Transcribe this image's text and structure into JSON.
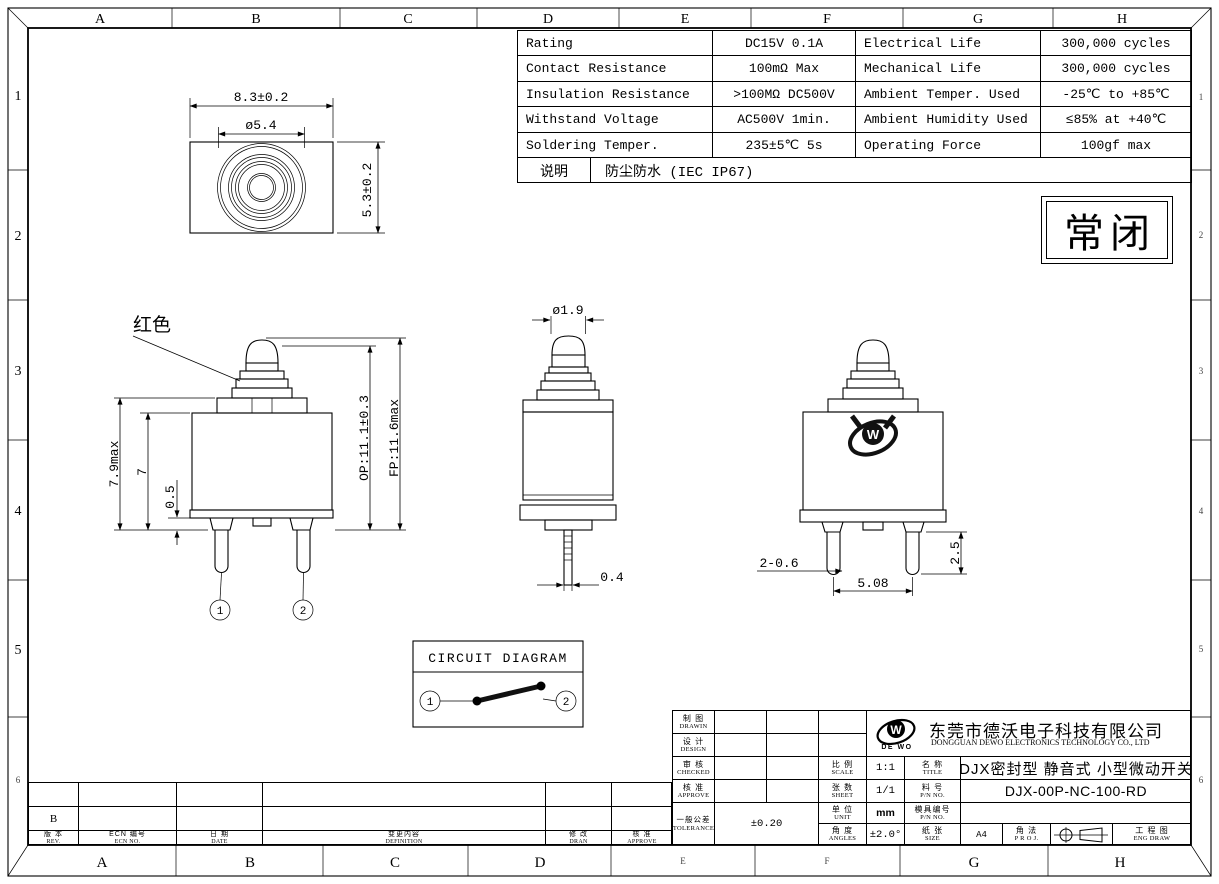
{
  "sheet": {
    "grid_top": [
      "A",
      "B",
      "C",
      "D",
      "E",
      "F",
      "G",
      "H"
    ],
    "grid_bottom": [
      "A",
      "B",
      "C",
      "D",
      "E",
      "F",
      "G",
      "H"
    ],
    "grid_left": [
      "1",
      "2",
      "3",
      "4",
      "5",
      "6"
    ],
    "grid_right": [
      "1",
      "2",
      "3",
      "4",
      "5",
      "6"
    ]
  },
  "spec_table": {
    "rows": [
      [
        "Rating",
        "DC15V 0.1A",
        "Electrical Life",
        "300,000 cycles"
      ],
      [
        "Contact Resistance",
        "100mΩ Max",
        "Mechanical Life",
        "300,000 cycles"
      ],
      [
        "Insulation Resistance",
        ">100MΩ DC500V",
        "Ambient Temper. Used",
        "-25℃ to +85℃"
      ],
      [
        "Withstand Voltage",
        "AC500V 1min.",
        "Ambient Humidity Used",
        "≤85% at +40℃"
      ],
      [
        "Soldering Temper.",
        "235±5℃ 5s",
        "Operating Force",
        "100gf max"
      ]
    ],
    "note_label": "说明",
    "note_value": "防尘防水 (IEC IP67)"
  },
  "state_box": {
    "label": "常闭"
  },
  "views": {
    "top_view": {
      "dim_width": "8.3±0.2",
      "dim_bezel": "ø5.4",
      "dim_height": "5.3±0.2"
    },
    "front_view": {
      "color_note": "红色",
      "dim_body": "7.9max",
      "dim_seven": "7",
      "dim_half": "0.5",
      "dim_op": "OP:11.1±0.3",
      "dim_fp": "FP:11.6max",
      "pin1": "1",
      "pin2": "2"
    },
    "side_view": {
      "dim_plunger": "ø1.9",
      "dim_pin": "0.4"
    },
    "back_view": {
      "dim_pin_width": "2-0.6",
      "dim_pitch": "5.08",
      "dim_pin_len": "2.5"
    }
  },
  "circuit": {
    "title": "CIRCUIT DIAGRAM",
    "terminal1": "1",
    "terminal2": "2"
  },
  "company": {
    "logo": "DE WO",
    "logo_w": "W",
    "name_cn": "东莞市德沃电子科技有限公司",
    "name_en": "DONGGUAN DEWO ELECTRONICS TECHNOLOGY CO., LTD"
  },
  "title_block": {
    "drawn_cn": "制 图",
    "drawn_en": "DRAWIN",
    "design_cn": "设 计",
    "design_en": "DESIGN",
    "checked_cn": "审 核",
    "checked_en": "CHECKED",
    "approve_cn": "核 准",
    "approve_en": "APPROVE",
    "tolerance_cn": "一般公差",
    "tolerance_en": "TOLERANCE",
    "tolerance_value": "±0.20",
    "scale_cn": "比 例",
    "scale_en": "SCALE",
    "scale_value": "1:1",
    "sheet_cn": "张 数",
    "sheet_en": "SHEET",
    "sheet_value": "1/1",
    "unit_cn": "单 位",
    "unit_en": "UNIT",
    "unit_value": "mm",
    "angles_cn": "角 度",
    "angles_en": "ANGLES",
    "angles_value": "±2.0°",
    "title_cn": "名 称",
    "title_en": "TITLE",
    "title_value": "DJX密封型 静音式 小型微动开关",
    "pn_cn": "料 号",
    "pn_en": "P/N NO.",
    "pn_value": "DJX-00P-NC-100-RD",
    "mold_cn": "模具编号",
    "mold_en": "P/N NO.",
    "size_cn": "纸 张",
    "size_en": "SIZE",
    "size_value": "A4",
    "proj_cn": "角 法",
    "proj_en": "P R O J.",
    "eng_cn": "工 程 图",
    "eng_en": "ENG DRAW"
  },
  "revision_table": {
    "rev_value": "B",
    "headers": [
      {
        "cn": "版 本",
        "en": "REV."
      },
      {
        "cn": "ECN 编号",
        "en": "ECN NO."
      },
      {
        "cn": "日 期",
        "en": "DATE"
      },
      {
        "cn": "变更内容",
        "en": "DEFINITION"
      },
      {
        "cn": "修 改",
        "en": "DRAN"
      },
      {
        "cn": "核 准",
        "en": "APPROVE"
      }
    ]
  }
}
